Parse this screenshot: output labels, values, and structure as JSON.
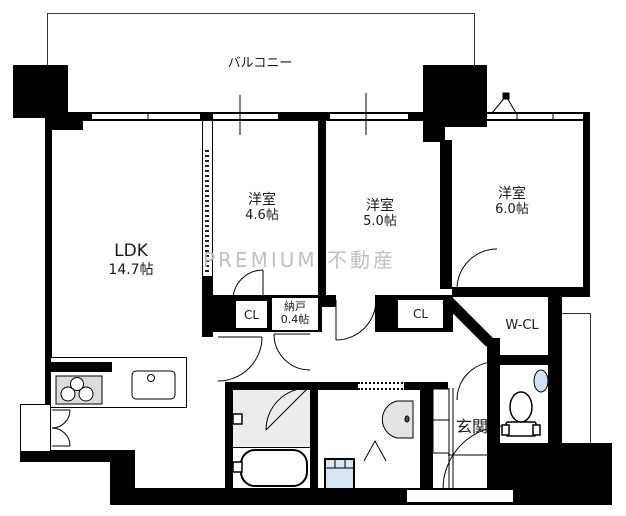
{
  "watermark": "PREMIUM 不動産",
  "rooms": {
    "balcony": {
      "label": "バルコニー"
    },
    "ldk": {
      "label": "LDK",
      "size": "14.7帖"
    },
    "bedroom46": {
      "label": "洋室",
      "size": "4.6帖"
    },
    "bedroom50": {
      "label": "洋室",
      "size": "5.0帖"
    },
    "bedroom60": {
      "label": "洋室",
      "size": "6.0帖"
    },
    "closet1": {
      "label": "CL"
    },
    "storage": {
      "label": "納戸",
      "size": "0.4帖"
    },
    "closet2": {
      "label": "CL"
    },
    "walk_in_closet": {
      "label": "W-CL"
    },
    "entrance": {
      "label": "玄関"
    }
  },
  "colors": {
    "wall": "#000000",
    "bath_floor": "#ececec",
    "appliance_blue": "#d6e6f5",
    "stove_grey": "#dcdcdc",
    "watermark_grey": "#b9b9b9"
  }
}
